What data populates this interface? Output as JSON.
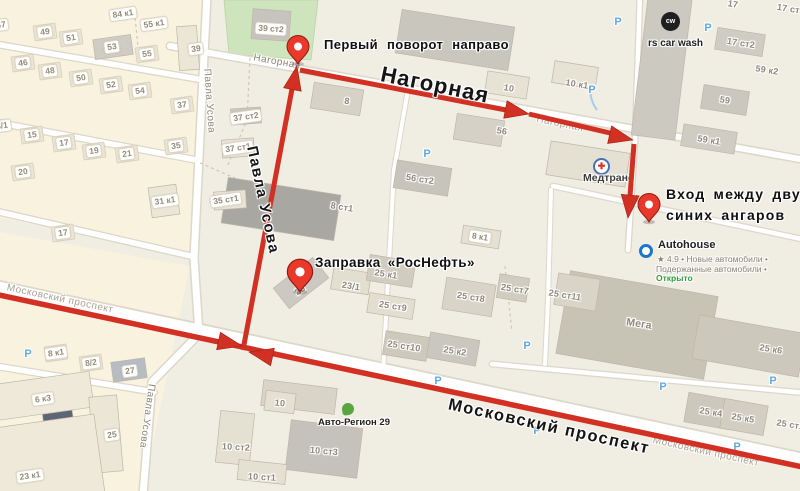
{
  "map": {
    "callouts": {
      "first_turn": "Первый поворот направо",
      "gas_station": "Заправка «РосНефть»",
      "entrance_line1": "Вход между двух",
      "entrance_line2": "синих ангаров"
    },
    "streets_big": {
      "nagornaya": "Нагорная",
      "pavla_usova": "Павла Усова",
      "moskovsky": "Московский проспект"
    },
    "pois": {
      "medtrans": {
        "label": "Медтранс",
        "icon_glyph": "✚"
      },
      "carwash": {
        "label": "rs car wash",
        "icon_text": "cw"
      },
      "autohouse": {
        "label": "Autohouse",
        "meta1": "★ 4.9 • Новые автомобили •",
        "meta2": "Подержанные автомобили •",
        "status": "Открыто"
      },
      "autoregion": {
        "label": "Авто-Регион 29"
      }
    },
    "street_labels_small": [
      {
        "text": "Нагорная",
        "x": 277,
        "y": 62,
        "rot": 10
      },
      {
        "text": "Нагорная",
        "x": 560,
        "y": 124,
        "rot": 12,
        "faint": true
      },
      {
        "text": "Павла Усова",
        "x": 209,
        "y": 101,
        "rot": 86
      },
      {
        "text": "Павла Усова",
        "x": 147,
        "y": 416,
        "rot": 98
      },
      {
        "text": "Московский проспект",
        "x": 706,
        "y": 452,
        "rot": 12.5,
        "faint": true
      },
      {
        "text": "Московский проспект",
        "x": 60,
        "y": 299,
        "rot": 12,
        "faint": true
      }
    ],
    "building_badges": [
      {
        "t": "47",
        "x": 1,
        "y": 25
      },
      {
        "t": "84 к1",
        "x": 123,
        "y": 14
      },
      {
        "t": "55 к1",
        "x": 154,
        "y": 24
      },
      {
        "t": "49",
        "x": 45,
        "y": 32,
        "h": 1
      },
      {
        "t": "51",
        "x": 71,
        "y": 38,
        "h": 1
      },
      {
        "t": "53",
        "x": 112,
        "y": 47
      },
      {
        "t": "55",
        "x": 147,
        "y": 54,
        "h": 1
      },
      {
        "t": "46",
        "x": 23,
        "y": 63,
        "h": 1
      },
      {
        "t": "48",
        "x": 50,
        "y": 71,
        "h": 1
      },
      {
        "t": "50",
        "x": 81,
        "y": 78,
        "h": 1
      },
      {
        "t": "52",
        "x": 111,
        "y": 85,
        "h": 1
      },
      {
        "t": "54",
        "x": 140,
        "y": 91,
        "h": 1
      },
      {
        "t": "39",
        "x": 196,
        "y": 49
      },
      {
        "t": "37",
        "x": 182,
        "y": 105,
        "h": 1
      },
      {
        "t": "35",
        "x": 176,
        "y": 146,
        "h": 1
      },
      {
        "t": "3/1",
        "x": 2,
        "y": 126
      },
      {
        "t": "15",
        "x": 32,
        "y": 135,
        "h": 1
      },
      {
        "t": "17",
        "x": 64,
        "y": 143,
        "h": 1
      },
      {
        "t": "19",
        "x": 94,
        "y": 151,
        "h": 1
      },
      {
        "t": "21",
        "x": 127,
        "y": 154,
        "h": 1
      },
      {
        "t": "20",
        "x": 23,
        "y": 172,
        "h": 1
      },
      {
        "t": "31 к1",
        "x": 165,
        "y": 201
      },
      {
        "t": "35 ст1",
        "x": 226,
        "y": 200
      },
      {
        "t": "37 ст1",
        "x": 238,
        "y": 148
      },
      {
        "t": "37 ст2",
        "x": 246,
        "y": 117
      },
      {
        "t": "39 ст2",
        "x": 271,
        "y": 29,
        "rot": 4
      },
      {
        "t": "17",
        "x": 63,
        "y": 233,
        "h": 1
      },
      {
        "t": "8 к1",
        "x": 56,
        "y": 353,
        "h": 1
      },
      {
        "t": "8/2",
        "x": 91,
        "y": 363,
        "h": 1
      },
      {
        "t": "27",
        "x": 130,
        "y": 371
      },
      {
        "t": "6 к3",
        "x": 43,
        "y": 399
      },
      {
        "t": "25",
        "x": 112,
        "y": 435
      },
      {
        "t": "23 к1",
        "x": 30,
        "y": 476
      },
      {
        "t": "8 к1",
        "x": 480,
        "y": 237,
        "rot": 9
      }
    ],
    "building_texts": [
      {
        "t": "8",
        "x": 347,
        "y": 101
      },
      {
        "t": "8 ст1",
        "x": 342,
        "y": 207
      },
      {
        "t": "56 ст2",
        "x": 420,
        "y": 179
      },
      {
        "t": "10",
        "x": 509,
        "y": 88
      },
      {
        "t": "10 к1",
        "x": 577,
        "y": 84
      },
      {
        "t": "56",
        "x": 502,
        "y": 131
      },
      {
        "t": "17",
        "x": 733,
        "y": 4
      },
      {
        "t": "17 ст1",
        "x": 791,
        "y": 9
      },
      {
        "t": "17 ст2",
        "x": 741,
        "y": 43
      },
      {
        "t": "59 к2",
        "x": 767,
        "y": 70
      },
      {
        "t": "59",
        "x": 725,
        "y": 100
      },
      {
        "t": "59 к1",
        "x": 709,
        "y": 140
      },
      {
        "t": "23",
        "x": 300,
        "y": 290,
        "rot": -35
      },
      {
        "t": "23/1",
        "x": 351,
        "y": 286
      },
      {
        "t": "25 к1",
        "x": 386,
        "y": 274
      },
      {
        "t": "25 ст9",
        "x": 393,
        "y": 306
      },
      {
        "t": "25 ст8",
        "x": 471,
        "y": 297
      },
      {
        "t": "25 ст7",
        "x": 515,
        "y": 289
      },
      {
        "t": "25 ст11",
        "x": 565,
        "y": 295
      },
      {
        "t": "25 ст10",
        "x": 404,
        "y": 346
      },
      {
        "t": "25 к2",
        "x": 455,
        "y": 351
      },
      {
        "t": "Мега",
        "x": 639,
        "y": 324,
        "s": 10.5
      },
      {
        "t": "25 к6",
        "x": 771,
        "y": 349
      },
      {
        "t": "25 к4",
        "x": 711,
        "y": 412
      },
      {
        "t": "25 к5",
        "x": 743,
        "y": 418
      },
      {
        "t": "25 ст12",
        "x": 793,
        "y": 425
      },
      {
        "t": "10",
        "x": 280,
        "y": 403,
        "rot": 5
      },
      {
        "t": "10 ст2",
        "x": 236,
        "y": 447,
        "rot": 3
      },
      {
        "t": "10 ст3",
        "x": 324,
        "y": 451,
        "rot": 5
      },
      {
        "t": "10 ст1",
        "x": 262,
        "y": 477,
        "rot": 3
      }
    ],
    "parking_positions": [
      {
        "x": 28,
        "y": 354
      },
      {
        "x": 427,
        "y": 154
      },
      {
        "x": 618,
        "y": 22
      },
      {
        "x": 708,
        "y": 28
      },
      {
        "x": 592,
        "y": 90
      },
      {
        "x": 537,
        "y": 431
      },
      {
        "x": 663,
        "y": 387
      },
      {
        "x": 737,
        "y": 447
      },
      {
        "x": 527,
        "y": 346
      },
      {
        "x": 438,
        "y": 381
      },
      {
        "x": 773,
        "y": 381
      }
    ],
    "colors": {
      "route": "#d13022",
      "pin": "#e8392b",
      "park_green": "#cde4bd",
      "parking_blue": "#64a9de",
      "open_green": "#2f9e44"
    }
  }
}
